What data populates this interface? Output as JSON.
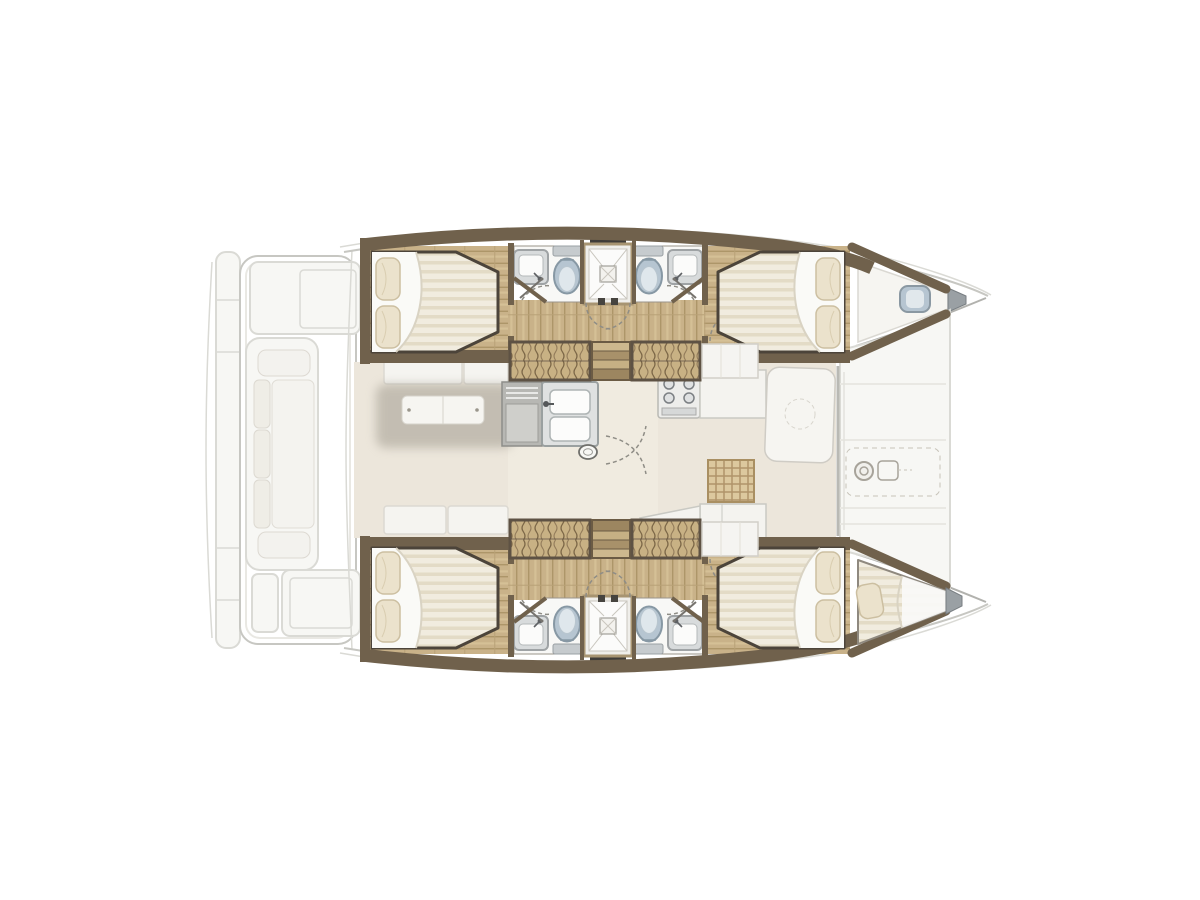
{
  "app": {
    "name": "catamaran-interior-floorplan",
    "view": "overhead-deck-plan",
    "orientation": "bow-right"
  },
  "colors": {
    "ghost": "#f7f7f4",
    "ghostLine": "#dadad5",
    "ghostDark": "#c7c7c2",
    "wall": "#70614c",
    "wood": "#c9b289",
    "woodDark": "#ad9669",
    "mattress": "#f1ecdf",
    "mattressStripe": "#e3dbc6",
    "pillow": "#ebe2cc",
    "bedFrame": "#4c443a",
    "bathFloor": "#f8f8f6",
    "fixtureBlue": "#b6c5d1",
    "fixtureBlueDark": "#8798a4",
    "steel": "#9aa0a4",
    "sinkGray": "#dfe1e1",
    "wardrobe": "#c8b184",
    "wardrobeLine": "#7d6848",
    "stepLight": "#cdb88e",
    "stepDark": "#9c8660",
    "salonFloor": "#ece6db",
    "walkway": "#f0ebe0",
    "counter": "#f4f3ef",
    "counterLine": "#c9c9c3",
    "shadow": "#a39d91",
    "arc": "#8f8d86",
    "white": "#ffffff"
  },
  "floorplan": {
    "hulls": [
      {
        "id": "port-hull",
        "position": "top",
        "rooms": [
          "aft-double-cabin",
          "aft-head",
          "shared-shower",
          "fore-head",
          "fore-double-cabin"
        ],
        "features": [
          "wardrobe",
          "companionway-steps",
          "wardrobe",
          "corridor",
          "bow-hatch"
        ]
      },
      {
        "id": "starboard-hull",
        "position": "bottom",
        "rooms": [
          "aft-double-cabin",
          "aft-head",
          "shared-shower",
          "fore-head",
          "fore-double-cabin",
          "bow-berth"
        ],
        "features": [
          "wardrobe",
          "companionway-steps",
          "wardrobe",
          "corridor"
        ]
      }
    ],
    "bridgedeck": {
      "ghosted": true,
      "zones": [
        "salon-benches",
        "salon-table",
        "galley-sink",
        "stove",
        "galley-counters",
        "teak-grating"
      ]
    },
    "exterior": {
      "ghosted": true,
      "zones": [
        "transom-platform",
        "aft-cockpit-sofa",
        "cockpit-table",
        "aft-sunpad",
        "foredeck",
        "anchor-windlass"
      ]
    },
    "counts": {
      "double_cabins": 4,
      "heads": 4,
      "showers": 2,
      "bow_berths": 1
    }
  }
}
